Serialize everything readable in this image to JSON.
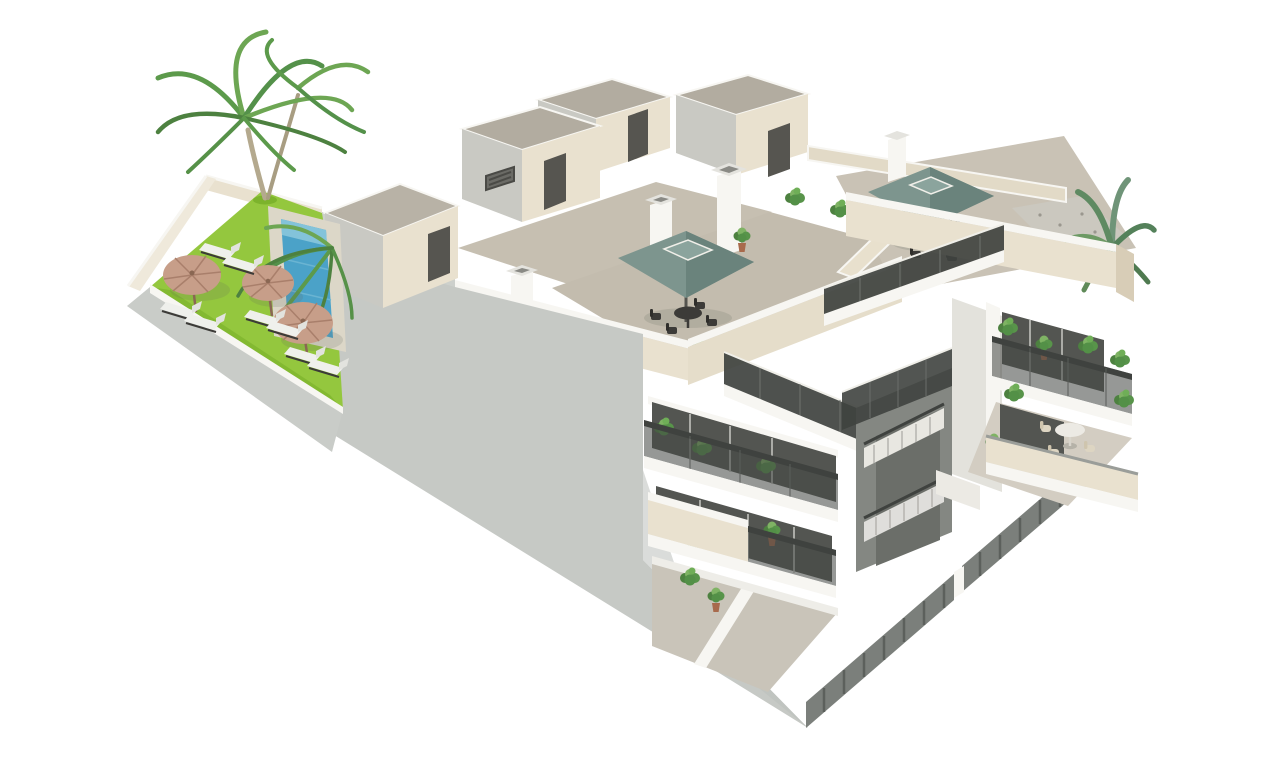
{
  "meta": {
    "kind": "architectural-3d-render",
    "description": "Isometric cutaway 3D render of a three-storey apartment building with rooftop terraces, central open staircase, balconies with plants, and a communal garden with swimming pool, palm trees, parasols and sun loungers on a plain white background"
  },
  "palette": {
    "background": "#ffffff",
    "gray_wall": "#c6c9c5",
    "garden_wall": "#c9ccc8",
    "cream_wall": "#e9e1cf",
    "cream_shade": "#d8cdb7",
    "trim_white": "#f7f6f2",
    "terrace_floor": "#c6bfb1",
    "roof_gray": "#b2aca0",
    "door_dark": "#565550",
    "glazing": "#535551",
    "grass": "#94c73e",
    "pool": "#4ba2c8",
    "umbrella": "#7d958e",
    "parasol": "#c79e89",
    "railing": "#3f423f",
    "fence": "#7b7f7b",
    "plant_green": "#58944a",
    "plant_light": "#7fb364",
    "palm_green": "#5c9a4b",
    "trunk": "#b4a98e",
    "pot": "#a86a4c",
    "furniture_dark": "#3c3b38",
    "table_white": "#eceae4"
  },
  "scene": {
    "garden": {
      "label": "communal garden",
      "palm_trees": 2,
      "parasols": 3,
      "sun_loungers": 8,
      "swimming_pool": 1
    },
    "building": {
      "label": "apartment building cutaway",
      "storeys": 3,
      "roof_terraces": 3,
      "square_umbrellas": 2,
      "rooftop_dining_sets": 2,
      "balcony_table_sets": 1,
      "penthouse_stair_boxes": 4,
      "chimneys": 4,
      "staircase": "central open stairwell with dark perforated metal railings",
      "balcony_railing_style": "dark perforated metal mesh",
      "ground_fence_style": "dark vertical slats",
      "corner_palm_plants": 1,
      "potted_plants": 24
    }
  }
}
